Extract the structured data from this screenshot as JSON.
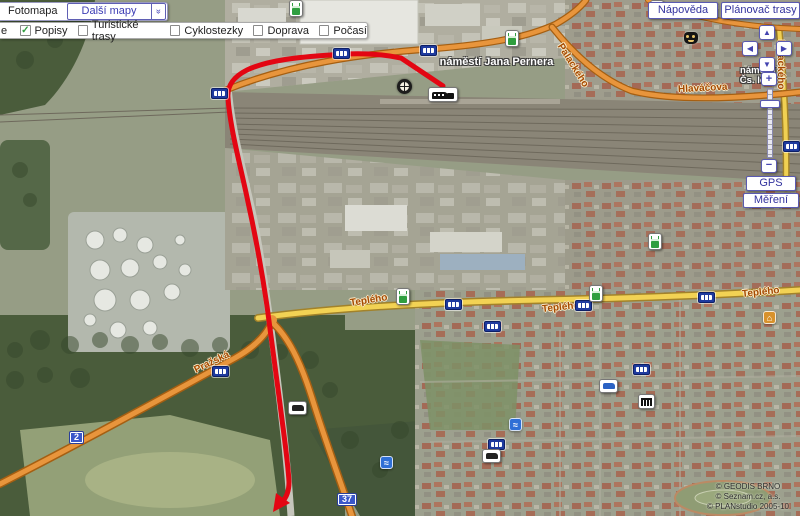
{
  "chrome": {
    "fotomapa_tab": "Fotomapa",
    "dalsi_mapy": "Další mapy",
    "left_cut_label": "e",
    "checkboxes": [
      {
        "label": "Popisy",
        "checked": true
      },
      {
        "label": "Turistické trasy",
        "checked": false
      },
      {
        "label": "Cyklostezky",
        "checked": false
      },
      {
        "label": "Doprava",
        "checked": false
      },
      {
        "label": "Počasí",
        "checked": false
      }
    ],
    "napoveda": "Nápověda",
    "planovac_trasy": "Plánovač trasy",
    "gps": "GPS",
    "mereni": "Měření"
  },
  "glyphs": {
    "check": "✓",
    "chevron": "»",
    "plus": "+",
    "minus": "−",
    "arrow_up": "▲",
    "arrow_down": "▼",
    "arrow_left": "◀",
    "arrow_right": "▶",
    "pool": "≈",
    "house": "⌂"
  },
  "map": {
    "place_labels": {
      "pernera": "náměstí Jana Pernera",
      "legii_line1": "náměstí",
      "legii_line2": "Čs. legií"
    },
    "street_labels": [
      "Hlaváčova",
      "Palackého",
      "Teplého",
      "Teplého",
      "Teplého",
      "Pražská",
      "Palackého"
    ],
    "road_numbers": {
      "d2": "2",
      "d37": "37"
    }
  },
  "copyright": [
    "© GEODIS BRNO",
    "© Seznam.cz, a.s.",
    "© PLANstudio 2005-10"
  ],
  "colors": {
    "accent": "#3c3cb4",
    "route_red": "#e30613",
    "road_orange": "#e8953c",
    "road_yellow": "#f2d254",
    "check_green": "#2f9e3f",
    "road_badge_blue": "#3a57c9",
    "bus_badge_navy": "#1e3a9e"
  }
}
